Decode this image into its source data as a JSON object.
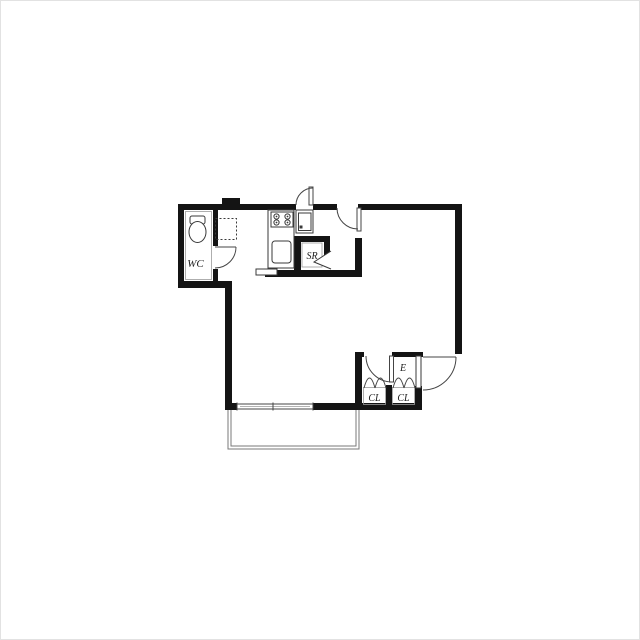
{
  "document": {
    "type": "apartment-floor-plan",
    "description": "One-room apartment floor plan with kitchen strip, WC, service room, entrance with closets, and balcony"
  },
  "rooms": {
    "wc": {
      "label": "WC"
    },
    "service_room": {
      "label": "SR"
    },
    "entrance": {
      "label": "E"
    },
    "closet_left": {
      "label": "CL"
    },
    "closet_right": {
      "label": "CL"
    }
  },
  "fixtures": {
    "toilet": "toilet-icon",
    "stove": "stove-burners-icon",
    "sink": "kitchen-sink-icon",
    "washer": "washing-machine-icon",
    "refrigerator_space": "refrigerator-space-dashed-icon",
    "window": "sliding-window-icon",
    "balcony": "balcony-rail-icon",
    "bifold_doors": "closet-bifold-door-icon",
    "swing_doors": "swing-door-arc-icon",
    "fold_door": "folding-door-chevron-icon"
  },
  "colors": {
    "wall": "#141414",
    "line": "#3a3a3a",
    "light_line": "#9a9a9a",
    "background": "#ffffff",
    "label": "#1d1d1d"
  }
}
